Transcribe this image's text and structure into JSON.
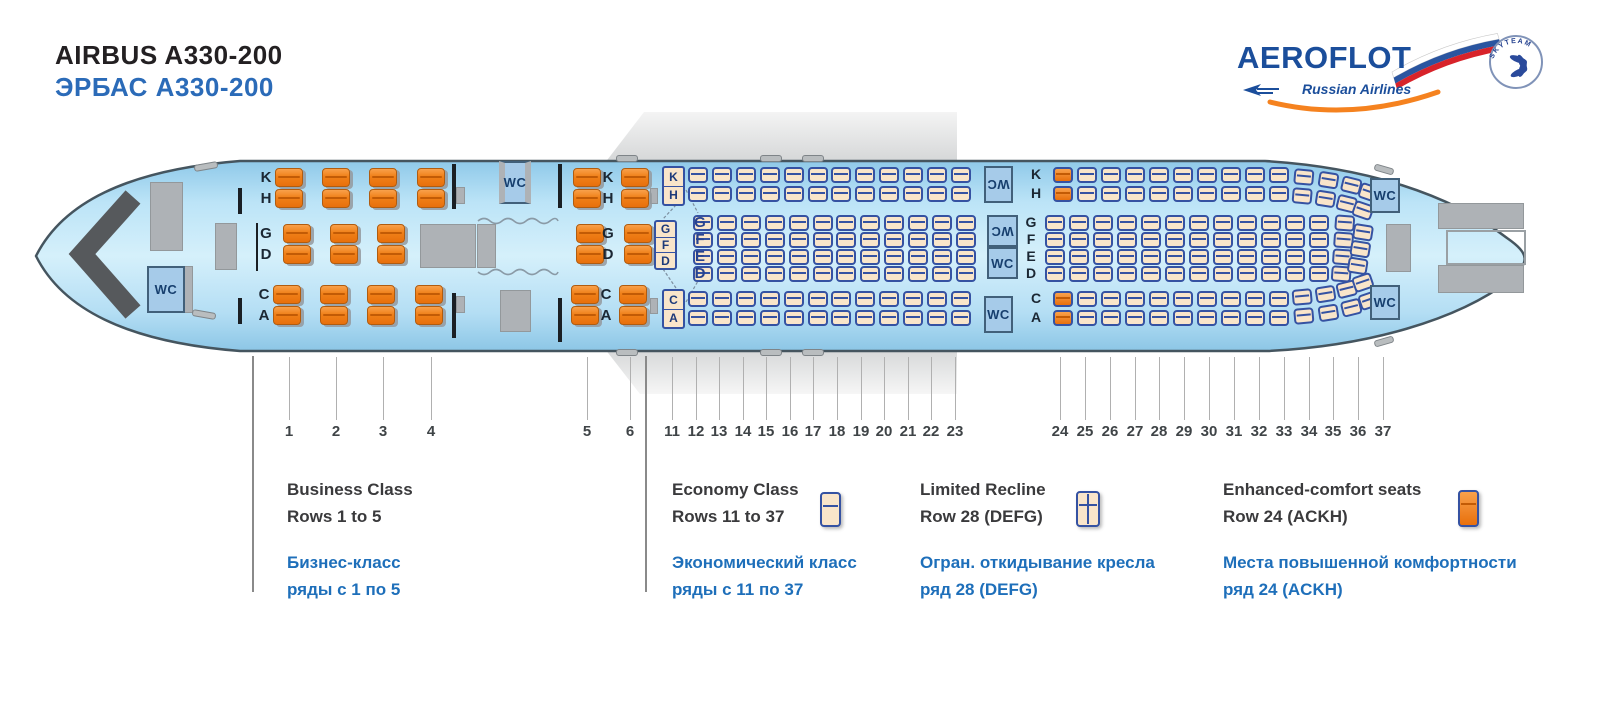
{
  "header": {
    "title_en": "AIRBUS A330-200",
    "title_ru": "ЭРБАС А330-200"
  },
  "brand": {
    "name": "AEROFLOT",
    "tagline": "Russian Airlines",
    "alliance": "SKYTEAM"
  },
  "colors": {
    "title_black": "#232022",
    "title_blue": "#2b6bb8",
    "brand_blue": "#1b4e9b",
    "brand_orange": "#f5821f",
    "fuselage_blue": "#bfe4f6",
    "business_seat_orange": "#f08018",
    "economy_seat_cream": "#f9e5ca",
    "seat_border_navy": "#3552a2",
    "legend_ru_blue": "#1e6fba",
    "galley_gray": "#aeb2b6"
  },
  "seatmap": {
    "wc_label": "WC",
    "business": {
      "rows": [
        1,
        2,
        3,
        4,
        5,
        6
      ],
      "columns": {
        "left_pair": [
          "K",
          "H"
        ],
        "center_pair": [
          "G",
          "D"
        ],
        "right_pair": [
          "C",
          "A"
        ]
      }
    },
    "economy": {
      "columns": {
        "left_pair": [
          "K",
          "H"
        ],
        "center_quad": [
          "G",
          "F",
          "E",
          "D"
        ],
        "right_pair": [
          "C",
          "A"
        ]
      },
      "row11_center": [
        "G",
        "F",
        "D"
      ],
      "enhanced_comfort_row": 24,
      "limited_recline_row": 28
    },
    "row_numbers": {
      "business": [
        1,
        2,
        3,
        4,
        5,
        6
      ],
      "economy_front": [
        11,
        12,
        13,
        14,
        15,
        16,
        17,
        18,
        19,
        20,
        21,
        22,
        23
      ],
      "economy_rear": [
        24,
        25,
        26,
        27,
        28,
        29,
        30,
        31,
        32,
        33,
        34,
        35,
        36,
        37
      ]
    }
  },
  "legend": {
    "items": [
      {
        "en_line1": "Business Class",
        "en_line2": "Rows 1 to 5",
        "ru_line1": "Бизнес-класс",
        "ru_line2": "ряды с 1 по 5"
      },
      {
        "en_line1": "Economy Class",
        "en_line2": "Rows 11 to 37",
        "ru_line1": "Экономический класс",
        "ru_line2": "ряды с 11 по 37"
      },
      {
        "en_line1": "Limited Recline",
        "en_line2": "Row 28 (DEFG)",
        "ru_line1": "Огран. откидывание кресла",
        "ru_line2": "ряд 28 (DEFG)"
      },
      {
        "en_line1": "Enhanced-comfort seats",
        "en_line2": "Row 24 (ACKH)",
        "ru_line1": "Места повышенной комфортности",
        "ru_line2": "ряд 24 (ACKH)"
      }
    ]
  }
}
